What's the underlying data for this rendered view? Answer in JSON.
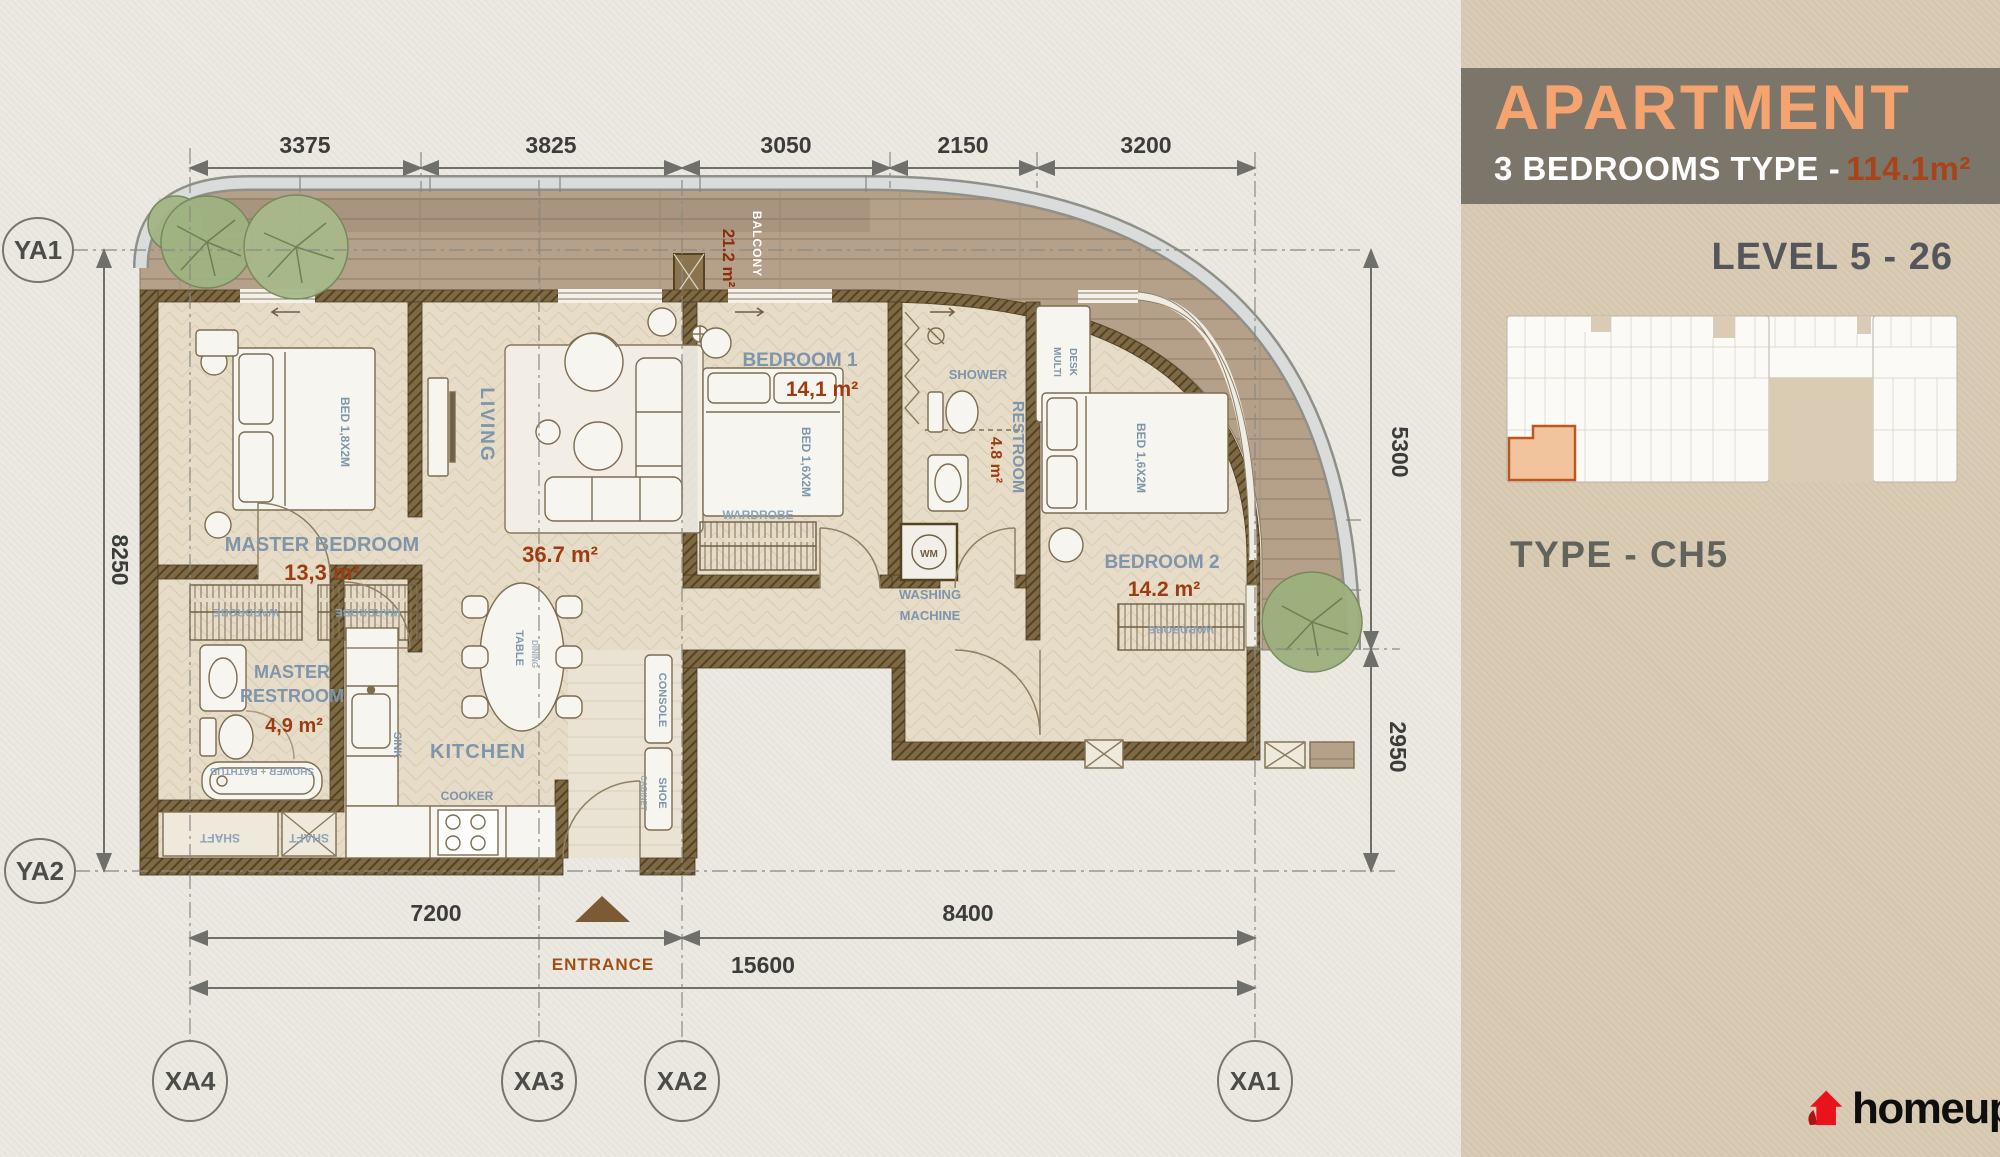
{
  "sidebar": {
    "title": "APARTMENT",
    "subtitle": "3 BEDROOMS TYPE",
    "dash": "-",
    "area": "114.1m²",
    "level": "LEVEL 5 - 26",
    "type_label": "TYPE - CH5",
    "brand": "homeup"
  },
  "plan": {
    "rooms": {
      "master_bedroom": {
        "name": "MASTER BEDROOM",
        "area": "13,3 m²"
      },
      "living": {
        "name": "LIVING",
        "area": "36.7 m²"
      },
      "kitchen": {
        "name": "KITCHEN"
      },
      "bedroom1": {
        "name": "BEDROOM 1",
        "area": "14,1 m²"
      },
      "restroom": {
        "name": "RESTROOM",
        "area": "4.8 m²"
      },
      "bedroom2": {
        "name": "BEDROOM 2",
        "area": "14.2 m²"
      },
      "master_restroom": {
        "line1": "MASTER",
        "line2": "RESTROOM",
        "area": "4,9 m²"
      },
      "balcony": {
        "name": "BALCONY",
        "area": "21.2 m²"
      },
      "washing_machine": {
        "line1": "WASHING",
        "line2": "MACHINE"
      }
    },
    "fixtures": {
      "shower": "SHOWER",
      "shower_bathtub": "SHOWER + BATHTUB",
      "wardrobe": "WARDROBE",
      "shaft": "SHAFT",
      "sink": "SINK",
      "cooker": "COOKER",
      "table": "TABLE",
      "dining": "DINING",
      "console": "CONSOLE",
      "shoe": "SHOE",
      "cabinet": "CABINET",
      "desk": "DESK",
      "multi": "MULTI",
      "wm": "WM"
    },
    "beds": {
      "master": "BED 1,8X2M",
      "standard": "BED 1,6X2M"
    },
    "dims": {
      "top": [
        "3375",
        "3825",
        "3050",
        "2150",
        "3200"
      ],
      "left": "8250",
      "right": [
        "5300",
        "2950"
      ],
      "bottom": [
        "7200",
        "8400"
      ],
      "total": "15600"
    },
    "grid": {
      "x": [
        "XA4",
        "XA3",
        "XA2",
        "XA1"
      ],
      "y": [
        "YA1",
        "YA2"
      ]
    },
    "entrance": "ENTRANCE"
  },
  "colors": {
    "accent_orange": "#f5a470",
    "rust": "#a8441c",
    "area_text": "#9c3c12",
    "label_blue": "#7e95aa",
    "band_gray": "#7c766a",
    "sidebar_beige": "#d9cbb4",
    "wall_brown": "#7d6946",
    "logo_red": "#e8131b"
  }
}
